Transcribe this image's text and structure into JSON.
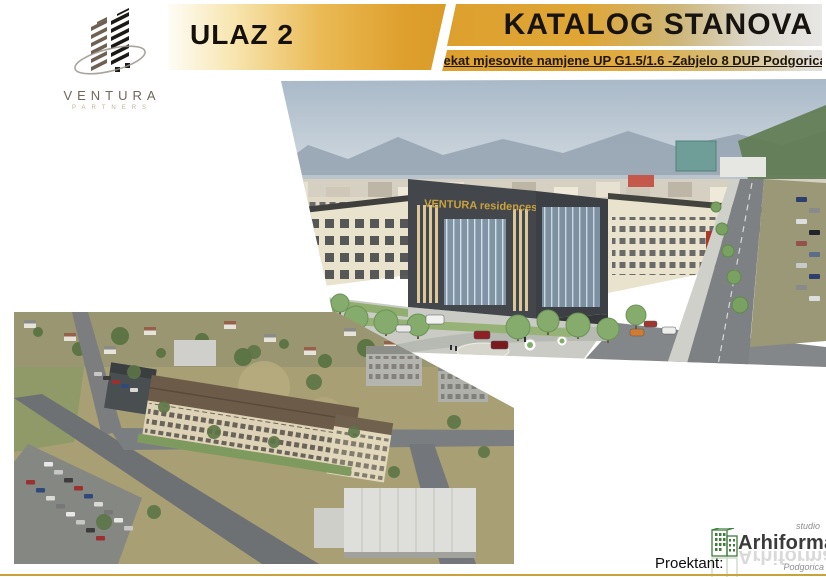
{
  "branding": {
    "ventura_name": "VENTURA",
    "ventura_sub": "PARTNERS"
  },
  "header": {
    "entrance_label": "ULAZ 2",
    "catalog_title": "KATALOG STANOVA",
    "subtitle": "Objekat mjesovite namjene UP G1.5/1.6  -Zabjelo 8 DUP Podgorica III"
  },
  "render": {
    "building_sign": "VENTURA residences"
  },
  "footer": {
    "designer_label": "Proektant:",
    "studio_word": "studio",
    "studio_name": "Arhiforma",
    "studio_city": "Podgorica"
  },
  "colors": {
    "banner_gold": "#DFA22F",
    "bottom_line_gold": "#C9A23E",
    "arhiforma_green": "#3E7C3A",
    "sign_gold": "#C9A23E"
  }
}
